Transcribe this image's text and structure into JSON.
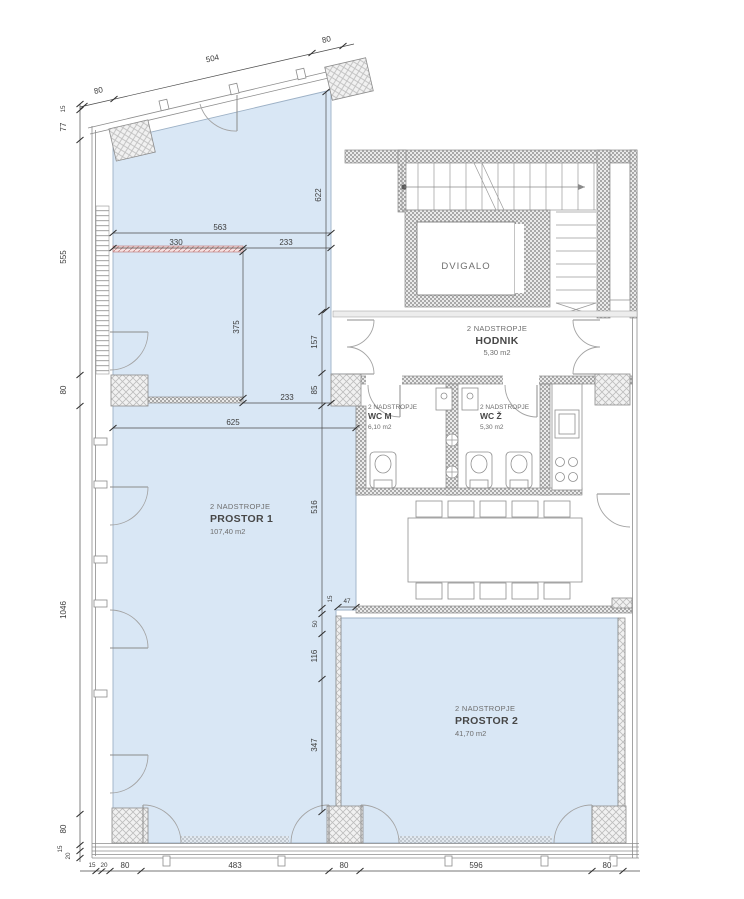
{
  "drawing": {
    "rooms": {
      "prostor1": {
        "floor": "2 NADSTROPJE",
        "name": "PROSTOR 1",
        "area": "107,40 m2"
      },
      "prostor2": {
        "floor": "2 NADSTROPJE",
        "name": "PROSTOR 2",
        "area": "41,70 m2"
      },
      "hodnik": {
        "floor": "2 NADSTROPJE",
        "name": "HODNIK",
        "area": "5,30 m2"
      },
      "wc_m": {
        "floor": "2 NADSTROPJE",
        "name": "WC M",
        "area": "6,10 m2"
      },
      "wc_z": {
        "floor": "2 NADSTROPJE",
        "name": "WC Ž",
        "area": "5,30 m2"
      },
      "dvigalo": {
        "name": "DVIGALO"
      }
    },
    "dims": {
      "top80l": "80",
      "top504": "504",
      "top80r": "80",
      "l15": "15",
      "l77": "77",
      "l555": "555",
      "l80a": "80",
      "l1046": "1046",
      "l80b": "80",
      "l15b": "15",
      "l20": "20",
      "b15": "15",
      "b20": "20",
      "b80a": "80",
      "b483": "483",
      "b80b": "80",
      "b596": "596",
      "b80c": "80",
      "i563": "563",
      "i330": "330",
      "i233a": "233",
      "i375": "375",
      "i622": "622",
      "i157": "157",
      "i85": "85",
      "i233b": "233",
      "i625": "625",
      "i516": "516",
      "i15": "15",
      "i47": "47",
      "i50": "50",
      "i116": "116",
      "i347": "347"
    },
    "colors": {
      "room_fill": "#d9e7f5",
      "wall": "#8c8c8c",
      "dim_text": "#3c3c3c",
      "red_wall": "#c98a8a"
    }
  }
}
